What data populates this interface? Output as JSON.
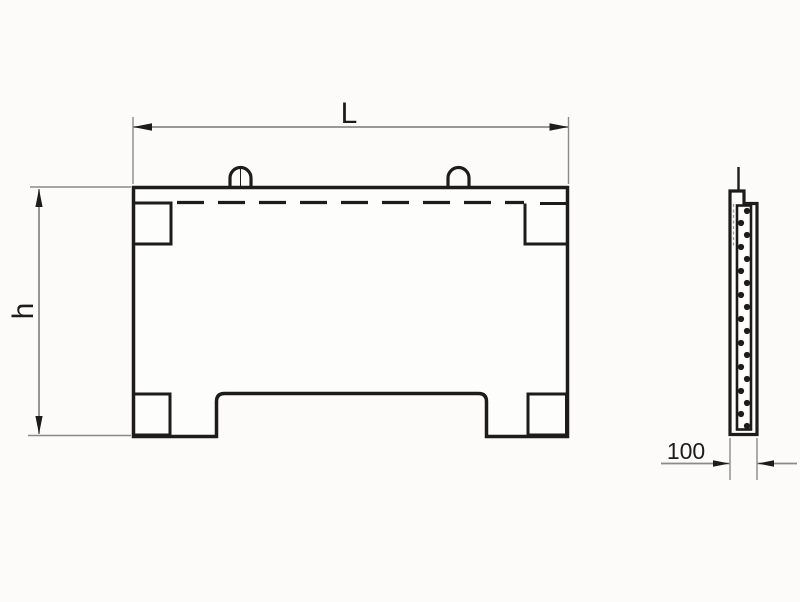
{
  "drawing": {
    "background": "#fcfbf9",
    "line_color": "#1e1c1a",
    "dim_line_color": "#8a8a8a",
    "front_view": {
      "length_label": "L",
      "height_label": "h",
      "lifting_loop_count": 2,
      "corner_anchor_count": 4
    },
    "side_view": {
      "thickness_label": "100",
      "thickness_value": 100,
      "rebar_dot_count": 19
    }
  }
}
